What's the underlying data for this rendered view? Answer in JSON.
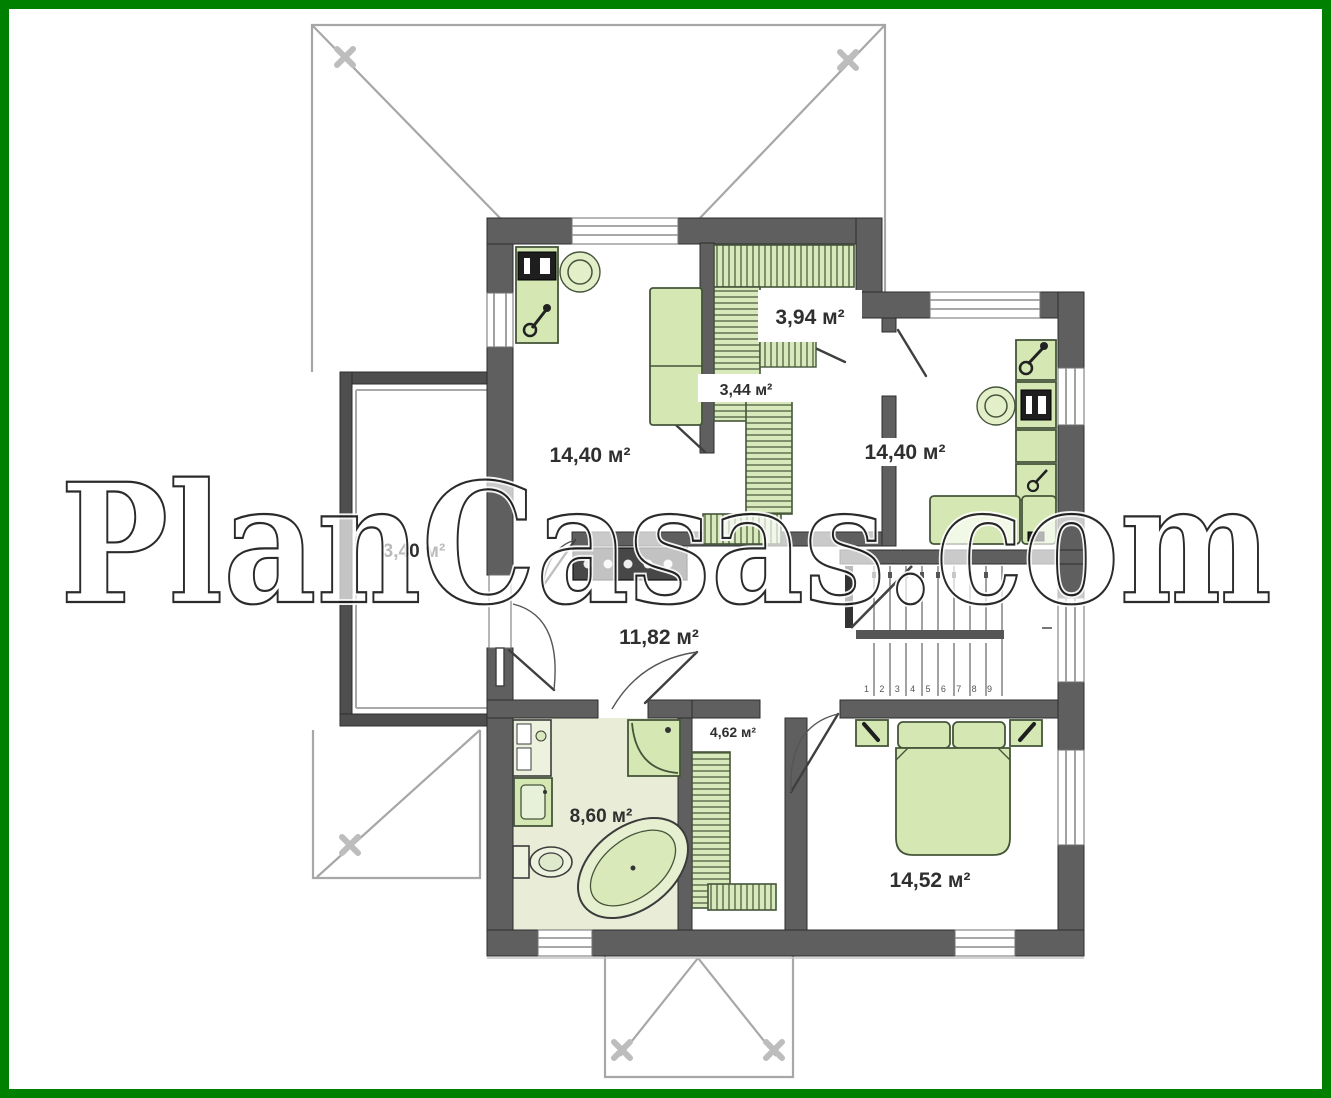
{
  "watermark": {
    "text": "PlanCasas.com"
  },
  "floor_plan": {
    "area_unit": "м²",
    "rooms": [
      {
        "id": "bedroom-top-left",
        "area": "14,40 м²"
      },
      {
        "id": "walk-in-closet",
        "area": "3,94 м²"
      },
      {
        "id": "closet-small",
        "area": "3,44 м²"
      },
      {
        "id": "bedroom-top-right",
        "area": "14,40 м²"
      },
      {
        "id": "balcony",
        "area": "3,40 м²"
      },
      {
        "id": "hall",
        "area": "11,82 м²"
      },
      {
        "id": "wardrobe",
        "area": "4,62 м²"
      },
      {
        "id": "bathroom",
        "area": "8,60 м²"
      },
      {
        "id": "bedroom-bottom",
        "area": "14,52 м²"
      }
    ],
    "stairs": {
      "step_numbers": "1 2 3 4 5 6 7 8 9"
    },
    "colors": {
      "border": "#008000",
      "wall": "#5f5f5f",
      "furniture_fill": "#d5e8b4",
      "bathroom_floor": "#e9edd8",
      "roof_line": "#a7a7a7"
    }
  }
}
